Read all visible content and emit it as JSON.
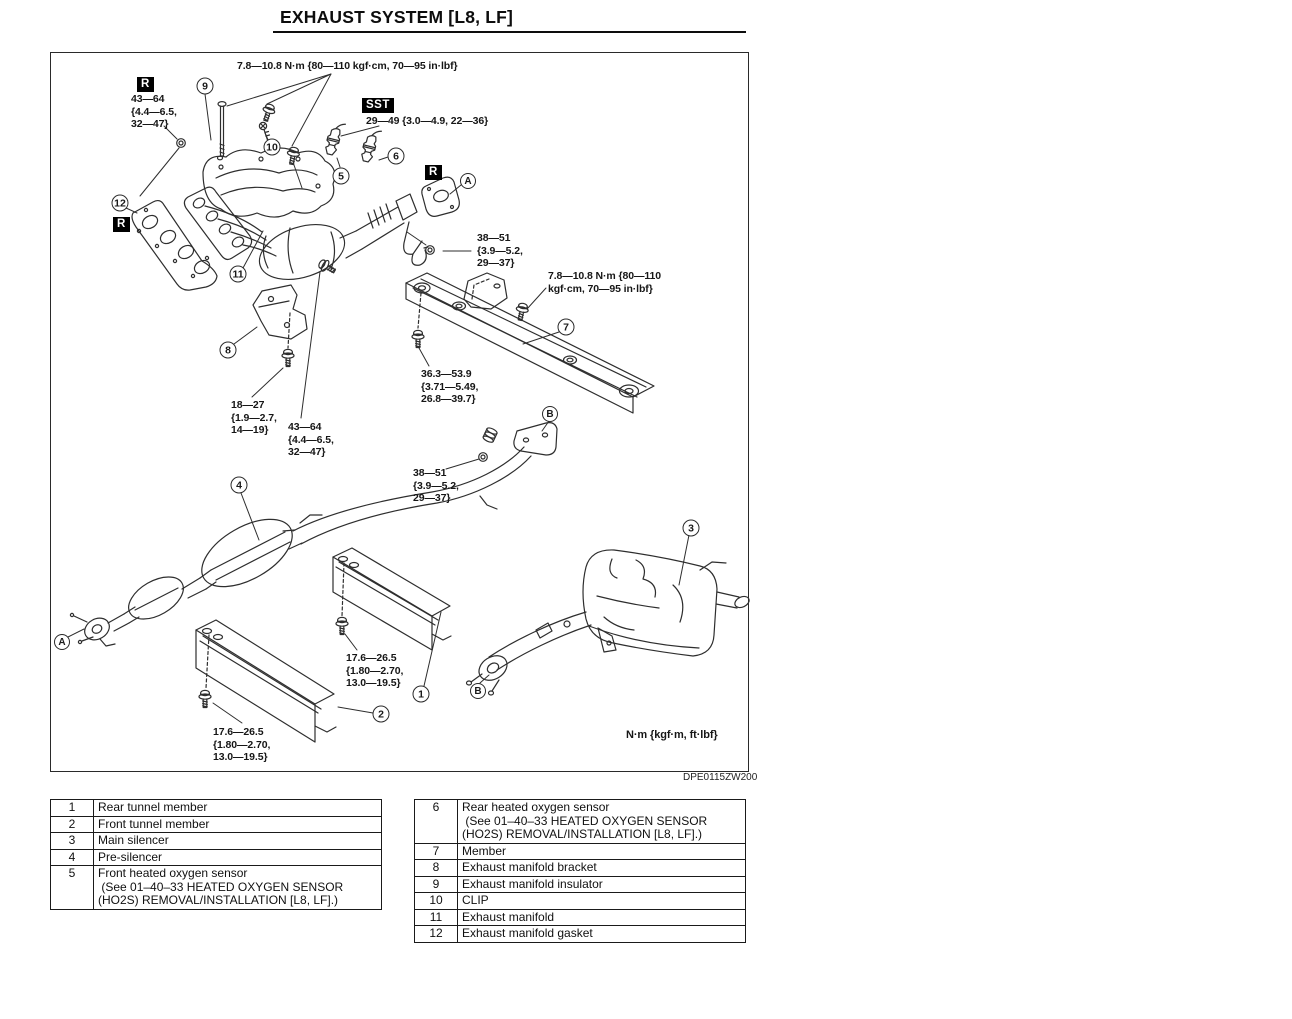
{
  "page": {
    "title": "EXHAUST SYSTEM [L8, LF]",
    "figure_code": "DPE0115ZW200"
  },
  "diagram": {
    "flags": [
      {
        "label": "R",
        "x": 137,
        "y": 77
      },
      {
        "label": "SST",
        "x": 362,
        "y": 98
      },
      {
        "label": "R",
        "x": 425,
        "y": 165
      },
      {
        "label": "R",
        "x": 113,
        "y": 217
      }
    ],
    "torque_labels": [
      {
        "name": "manifold-nut-torque",
        "x": 237,
        "y": 60,
        "lines": [
          "7.8—10.8 N·m {80—110 kgf·cm, 70—95 in·lbf}"
        ]
      },
      {
        "name": "flange-r-torque",
        "x": 131,
        "y": 93,
        "lines": [
          "43—64",
          "{4.4—6.5,",
          "32—47}"
        ]
      },
      {
        "name": "sensor-sst-torque",
        "x": 366,
        "y": 115,
        "lines": [
          "29—49 {3.0—4.9, 22—36}"
        ]
      },
      {
        "name": "flange-a-torque",
        "x": 477,
        "y": 232,
        "lines": [
          "38—51",
          "{3.9—5.2,",
          "29—37}"
        ]
      },
      {
        "name": "member-bolt-torque",
        "x": 548,
        "y": 270,
        "lines": [
          "7.8—10.8 N·m {80—110",
          "kgf·cm, 70—95 in·lbf}"
        ]
      },
      {
        "name": "member-mount-torque",
        "x": 421,
        "y": 368,
        "lines": [
          "36.3—53.9",
          "{3.71—5.49,",
          "26.8—39.7}"
        ]
      },
      {
        "name": "bracket-bolt-torque",
        "x": 231,
        "y": 399,
        "lines": [
          "18—27",
          "{1.9—2.7,",
          "14—19}"
        ]
      },
      {
        "name": "converter-flange-torque",
        "x": 288,
        "y": 421,
        "lines": [
          "43—64",
          "{4.4—6.5,",
          "32—47}"
        ]
      },
      {
        "name": "flange-b-torque",
        "x": 413,
        "y": 467,
        "lines": [
          "38—51",
          "{3.9—5.2,",
          "29—37}"
        ]
      },
      {
        "name": "rear-tunnel-bolt-torque",
        "x": 346,
        "y": 652,
        "lines": [
          "17.6—26.5",
          "{1.80—2.70,",
          "13.0—19.5}"
        ]
      },
      {
        "name": "front-tunnel-bolt-torque",
        "x": 213,
        "y": 726,
        "lines": [
          "17.6—26.5",
          "{1.80—2.70,",
          "13.0—19.5}"
        ]
      },
      {
        "name": "units-note",
        "x": 626,
        "y": 729,
        "lines": [
          "N·m {kgf·m, ft·lbf}"
        ]
      }
    ],
    "callouts": [
      {
        "label": "9",
        "x": 205,
        "y": 86
      },
      {
        "label": "10",
        "x": 272,
        "y": 147
      },
      {
        "label": "5",
        "x": 341,
        "y": 176
      },
      {
        "label": "6",
        "x": 396,
        "y": 156
      },
      {
        "label": "A",
        "x": 468,
        "y": 181
      },
      {
        "label": "12",
        "x": 120,
        "y": 203
      },
      {
        "label": "11",
        "x": 238,
        "y": 274
      },
      {
        "label": "8",
        "x": 228,
        "y": 350
      },
      {
        "label": "7",
        "x": 566,
        "y": 327
      },
      {
        "label": "B",
        "x": 550,
        "y": 414
      },
      {
        "label": "4",
        "x": 239,
        "y": 485
      },
      {
        "label": "A",
        "x": 62,
        "y": 642
      },
      {
        "label": "1",
        "x": 421,
        "y": 694
      },
      {
        "label": "2",
        "x": 381,
        "y": 714
      },
      {
        "label": "3",
        "x": 691,
        "y": 528
      },
      {
        "label": "B",
        "x": 478,
        "y": 691
      }
    ]
  },
  "tables": {
    "left_rows": [
      {
        "num": "1",
        "lines": [
          "Rear tunnel member"
        ]
      },
      {
        "num": "2",
        "lines": [
          "Front tunnel member"
        ]
      },
      {
        "num": "3",
        "lines": [
          "Main silencer"
        ]
      },
      {
        "num": "4",
        "lines": [
          "Pre-silencer"
        ]
      },
      {
        "num": "5",
        "lines": [
          "Front heated oxygen sensor",
          " (See 01–40–33 HEATED OXYGEN SENSOR",
          "(HO2S) REMOVAL/INSTALLATION [L8, LF].)"
        ]
      }
    ],
    "right_rows": [
      {
        "num": "6",
        "lines": [
          "Rear heated oxygen sensor",
          " (See 01–40–33 HEATED OXYGEN SENSOR",
          "(HO2S) REMOVAL/INSTALLATION [L8, LF].)"
        ]
      },
      {
        "num": "7",
        "lines": [
          "Member"
        ]
      },
      {
        "num": "8",
        "lines": [
          "Exhaust manifold bracket"
        ]
      },
      {
        "num": "9",
        "lines": [
          "Exhaust manifold insulator"
        ]
      },
      {
        "num": "10",
        "lines": [
          "CLIP"
        ]
      },
      {
        "num": "11",
        "lines": [
          "Exhaust manifold"
        ]
      },
      {
        "num": "12",
        "lines": [
          "Exhaust manifold gasket"
        ]
      }
    ]
  }
}
